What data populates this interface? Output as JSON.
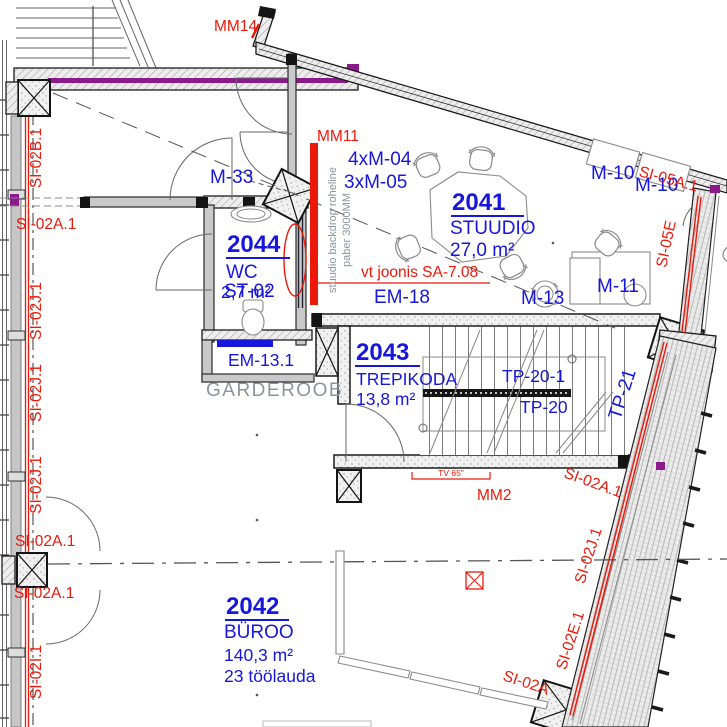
{
  "colors": {
    "annotation_red": "#ec1809",
    "label_blue": "#1616dd",
    "note_gray": "#8d939c",
    "accent_purple": "#8b1a8b",
    "wall_dark": "#141414"
  },
  "rooms": [
    {
      "number": "2041",
      "name": "STUUDIO",
      "area": "27,0 m²"
    },
    {
      "number": "2042",
      "name": "BÜROO",
      "area": "140,3 m²",
      "desks": "23 töölauda"
    },
    {
      "number": "2043",
      "name": "TREPIKODA",
      "area": "13,8 m²"
    },
    {
      "number": "2044",
      "name": "WC",
      "area": "2,7 m²",
      "code": "ST-02"
    }
  ],
  "equipment": {
    "m33": "M-33",
    "m04": "4xM-04",
    "m05": "3xM-05",
    "m10a": "M-10",
    "m10b": "M-10",
    "m11": "M-11",
    "m13": "M-13",
    "em18": "EM-18",
    "em131": "EM-13.1",
    "tp201": "TP-20-1",
    "tp20": "TP-20",
    "tp21": "TP-21",
    "garderoob": "GARDEROOB"
  },
  "marks": {
    "mm14": "MM14",
    "mm11": "MM11",
    "mm2": "MM2",
    "tv": "TV 65\""
  },
  "notes": {
    "backdrop1": "stuudio backdrop roheline",
    "backdrop2": "paber 3000MM",
    "ref": "vt joonis SA-7.08"
  },
  "annotations": {
    "left": [
      "SI-02B.1",
      "SI-02A.1",
      "SI-02J.1",
      "SI-02J.1",
      "SI-02J.1",
      "SI-02A.1",
      "SI-02A.1",
      "SI-02I.1"
    ],
    "right": [
      "SI-05A.1",
      "SI-05E",
      "SI-02A.1",
      "SI-02J.1",
      "SI-02E.1",
      "SI-02A"
    ]
  }
}
